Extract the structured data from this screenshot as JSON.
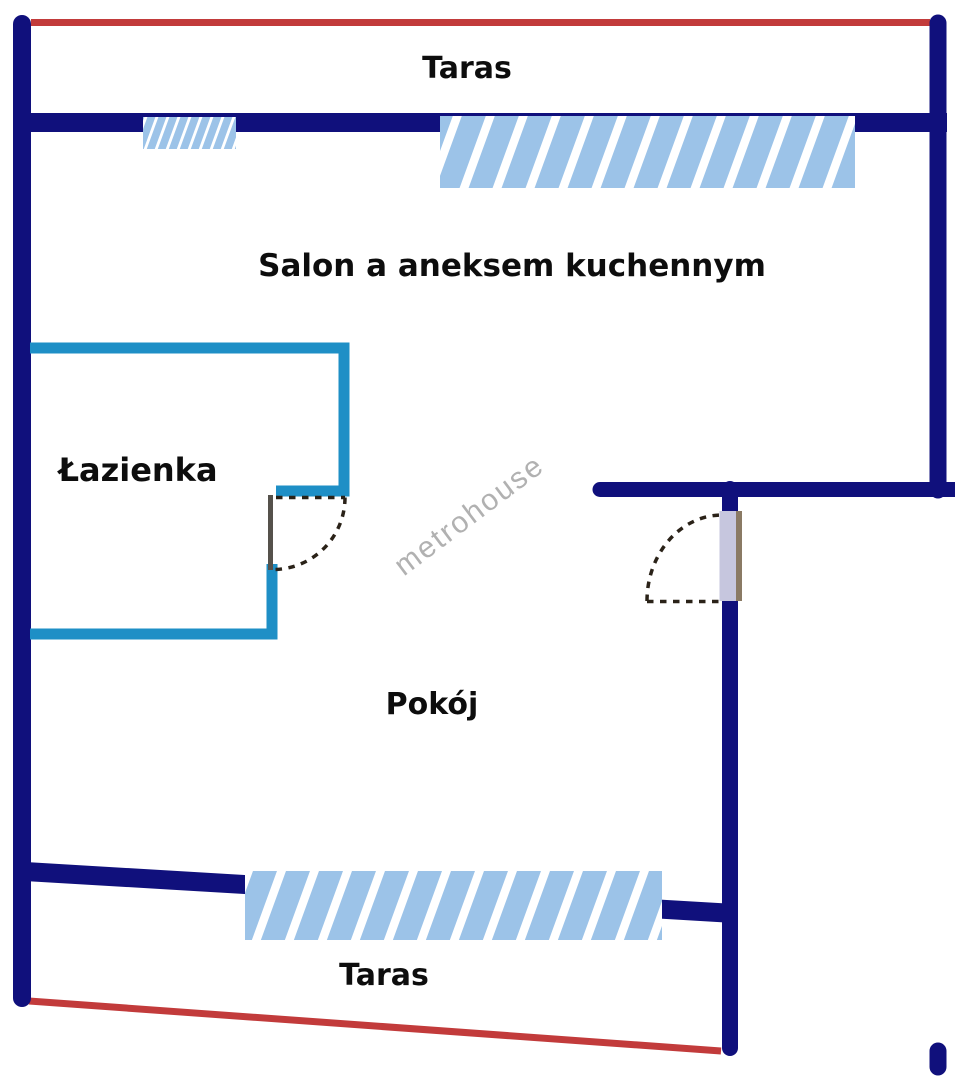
{
  "floorplan": {
    "watermark": "metrohouse",
    "labels": {
      "taras_top": "Taras",
      "salon": "Salon a aneksem kuchennym",
      "lazienka": "Łazienka",
      "pokoj": "Pokój",
      "taras_bottom": "Taras"
    },
    "colors": {
      "background": "#ffffff",
      "wall": "#10107c",
      "terrace_line": "#c23b3b",
      "window_fill": "#9cc3e8",
      "window_stripe": "#ffffff",
      "bathroom_wall": "#1e8fc6",
      "door_leaf": "#c6c6de",
      "door_leaf_edge": "#8a7a64",
      "bathroom_door_leaf": "#55514b",
      "door_swing": "#2a2218",
      "label_text": "#0d0d0d",
      "watermark": "#a9a9a9"
    }
  }
}
